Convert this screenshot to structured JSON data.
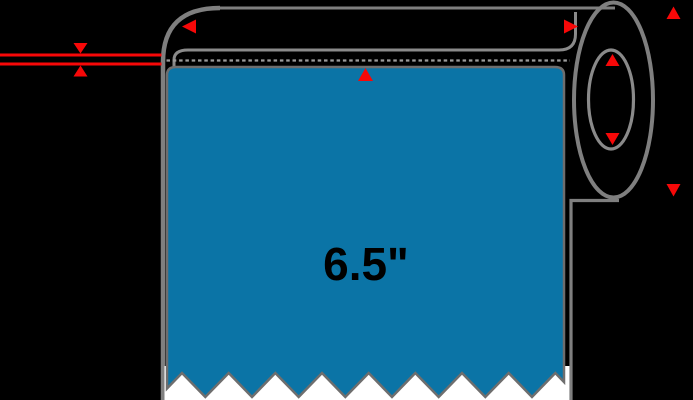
{
  "diagram": {
    "title": "label-roll-dimension-diagram",
    "label_width": "6.5\"",
    "core_diameter": "1\""
  },
  "colors": {
    "background": "#000000",
    "label_blue": "#0b74a6",
    "outline_gray": "#7f7f7f",
    "dash_gray": "#9c9c9c",
    "liner_white": "#ffffff",
    "arrow_red": "#f70808",
    "text_black": "#000000"
  },
  "icons": {
    "roll_width_left": "arrow-left-icon",
    "roll_width_right": "arrow-right-icon",
    "label_edge_pointer": "arrow-up-icon",
    "web_thickness_top": "arrow-down-icon",
    "web_thickness_bottom": "arrow-up-icon",
    "core_diameter_top": "arrow-up-icon",
    "core_diameter_bottom": "arrow-down-icon",
    "outer_diameter_top": "arrow-up-icon",
    "outer_diameter_bottom": "arrow-down-icon"
  }
}
